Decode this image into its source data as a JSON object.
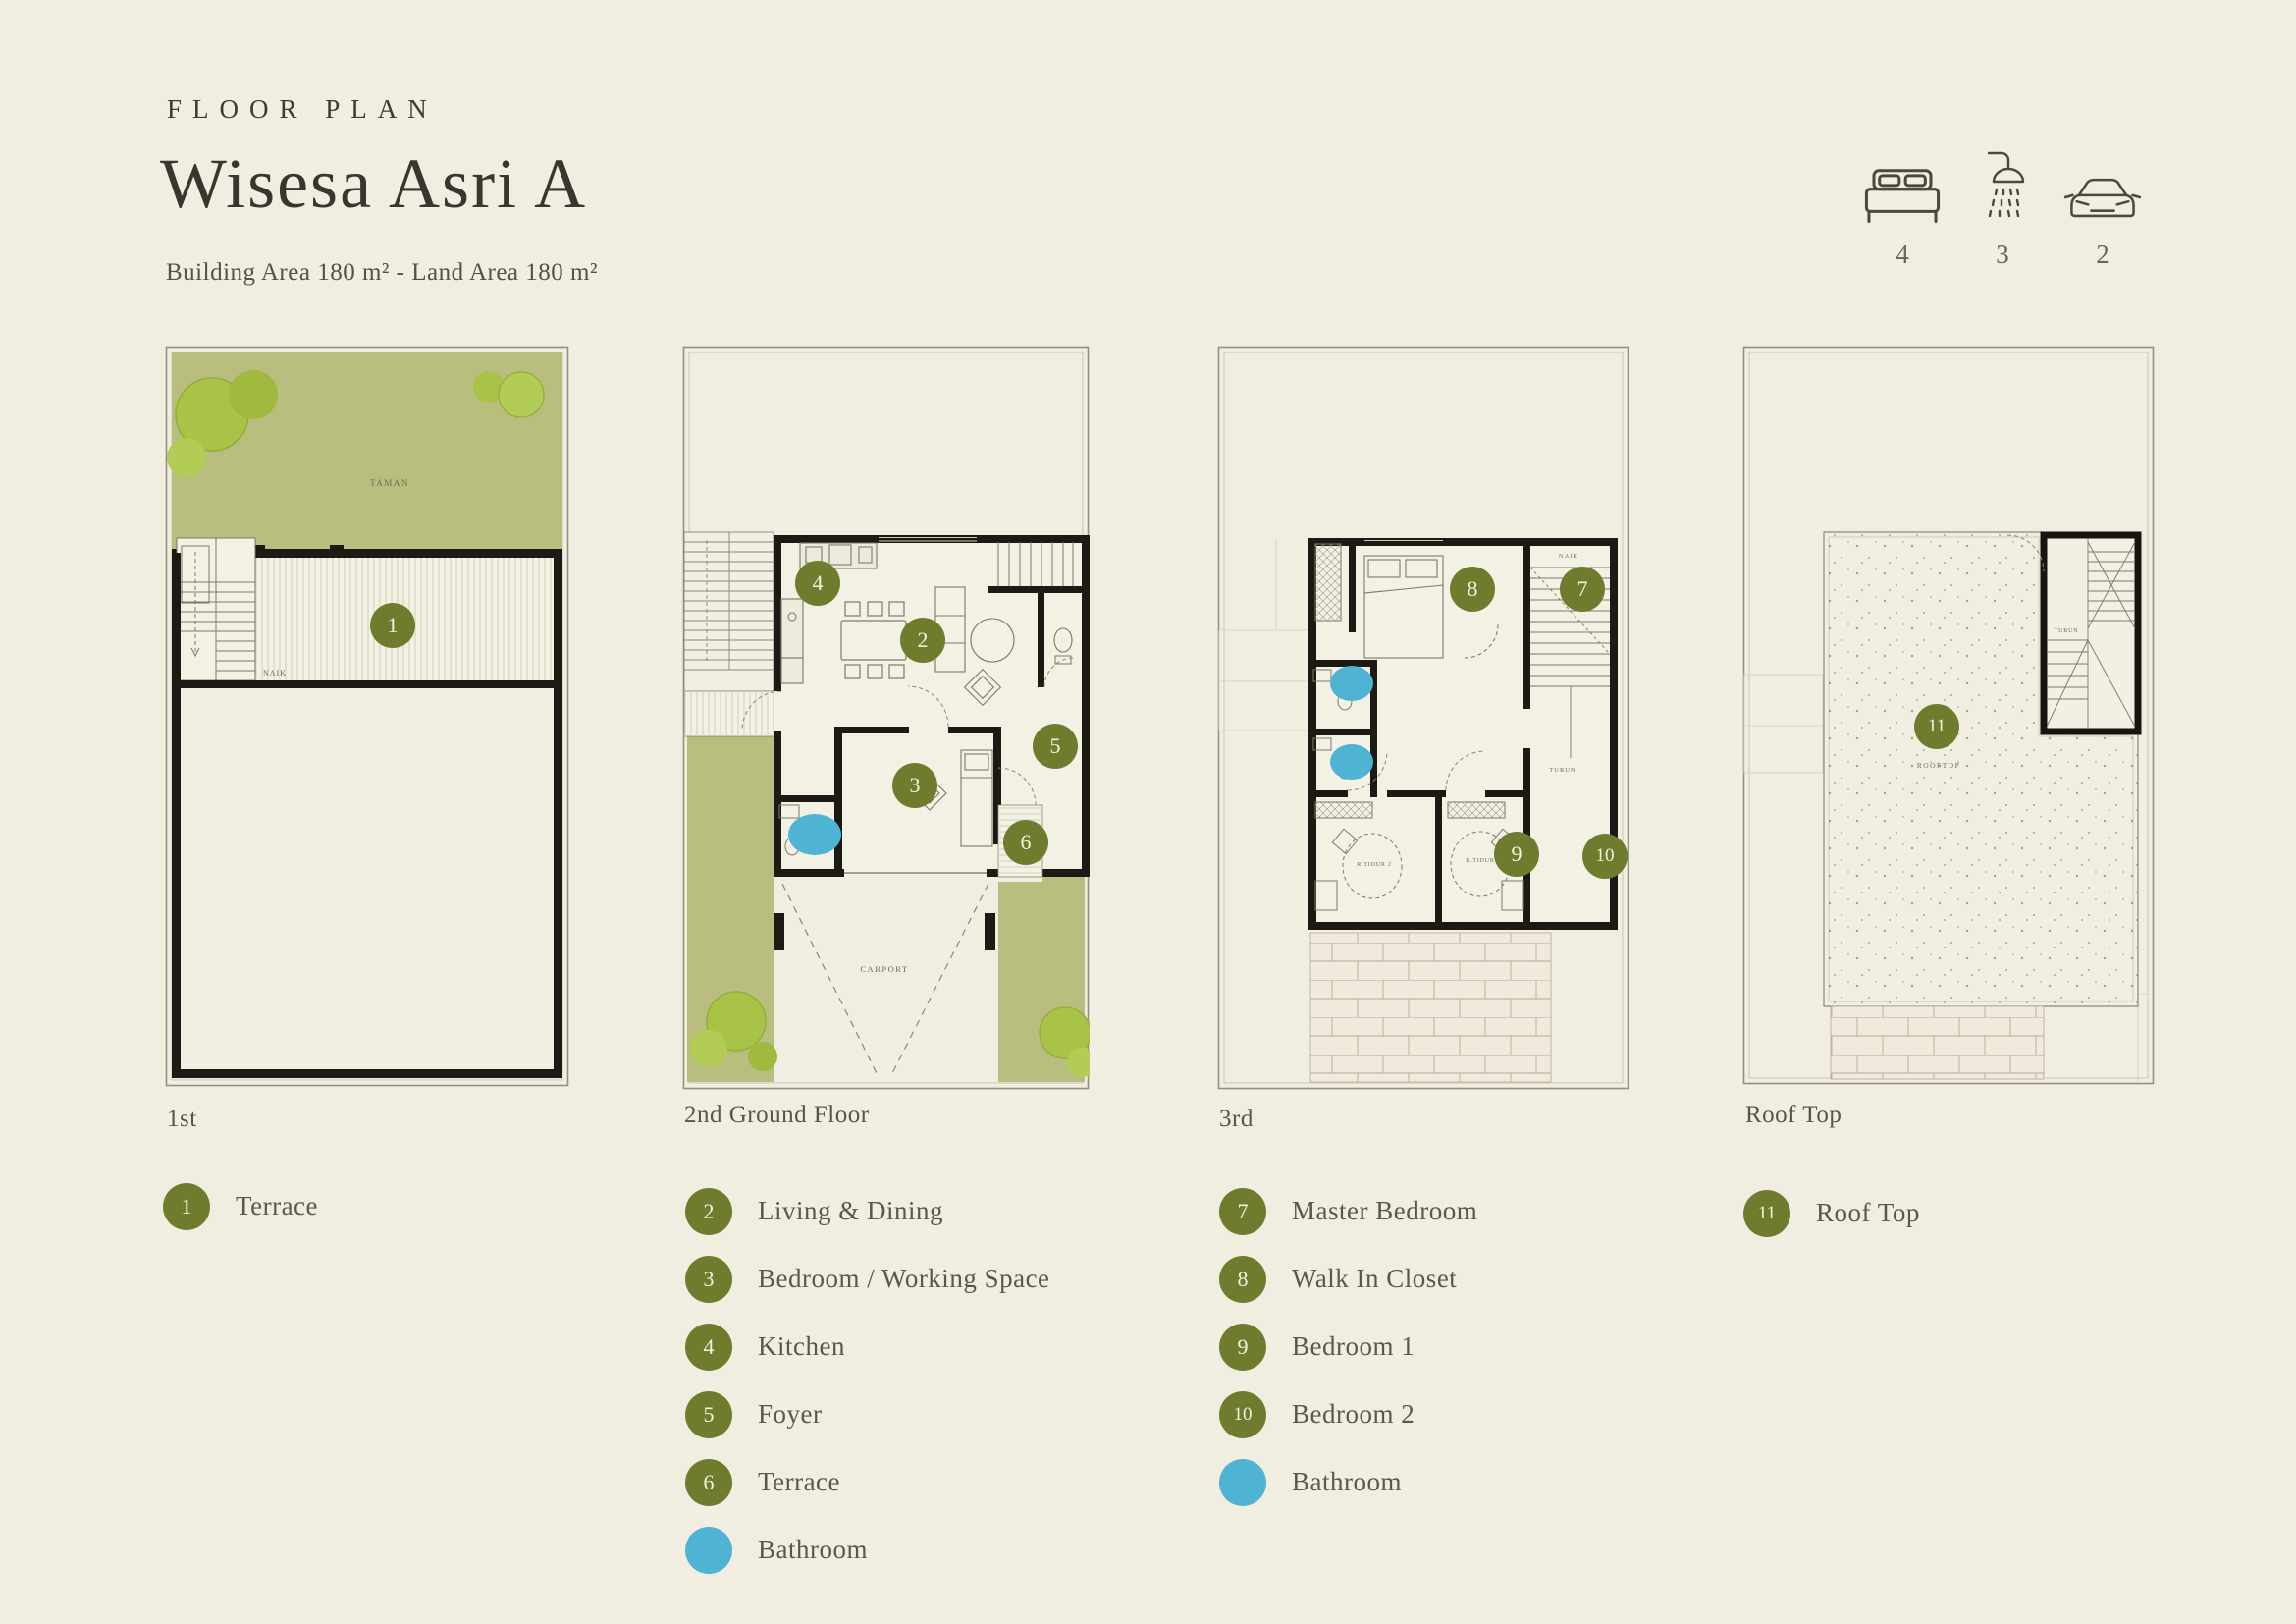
{
  "header": {
    "eyebrow": "FLOOR PLAN",
    "title": "Wisesa Asri A",
    "subtitle": "Building Area 180 m² - Land Area 180 m²"
  },
  "stats": {
    "items": [
      {
        "icon": "bed-icon",
        "value": "4"
      },
      {
        "icon": "shower-icon",
        "value": "3"
      },
      {
        "icon": "car-icon",
        "value": "2"
      }
    ]
  },
  "colors": {
    "background": "#f1ede0",
    "accent_olive": "#6f7c2d",
    "accent_blue": "#4fb3d4",
    "garden_green": "#b9bd7e",
    "wall_black": "#1c1a15"
  },
  "plans": [
    {
      "label": "1st",
      "annotations": {
        "garden": "TAMAN",
        "stairs_up": "NAIK"
      },
      "markers": [
        {
          "n": "1"
        }
      ]
    },
    {
      "label": "2nd Ground Floor",
      "annotations": {
        "carport": "CARPORT"
      },
      "markers": [
        {
          "n": "2"
        },
        {
          "n": "3"
        },
        {
          "n": "4"
        },
        {
          "n": "5"
        },
        {
          "n": "6"
        }
      ]
    },
    {
      "label": "3rd",
      "annotations": {
        "stairs_up": "NAIK",
        "stairs_down": "TURUN",
        "bedroom2_label": "R.TIDUR 2",
        "bedroom1_label": "R.TIDUR"
      },
      "markers": [
        {
          "n": "7"
        },
        {
          "n": "8"
        },
        {
          "n": "9"
        },
        {
          "n": "10"
        }
      ]
    },
    {
      "label": "Roof Top",
      "annotations": {
        "stairs_down": "TURUN",
        "rooftop": "ROOFTOP"
      },
      "markers": [
        {
          "n": "11"
        }
      ]
    }
  ],
  "legends": [
    {
      "items": [
        {
          "marker": "1",
          "label": "Terrace"
        }
      ]
    },
    {
      "items": [
        {
          "marker": "2",
          "label": "Living & Dining"
        },
        {
          "marker": "3",
          "label": "Bedroom / Working Space"
        },
        {
          "marker": "4",
          "label": "Kitchen"
        },
        {
          "marker": "5",
          "label": "Foyer"
        },
        {
          "marker": "6",
          "label": "Terrace"
        },
        {
          "marker": "",
          "label": "Bathroom"
        }
      ]
    },
    {
      "items": [
        {
          "marker": "7",
          "label": "Master Bedroom"
        },
        {
          "marker": "8",
          "label": "Walk In Closet"
        },
        {
          "marker": "9",
          "label": "Bedroom 1"
        },
        {
          "marker": "10",
          "label": "Bedroom 2"
        },
        {
          "marker": "",
          "label": "Bathroom"
        }
      ]
    },
    {
      "items": [
        {
          "marker": "11",
          "label": "Roof Top"
        }
      ]
    }
  ]
}
